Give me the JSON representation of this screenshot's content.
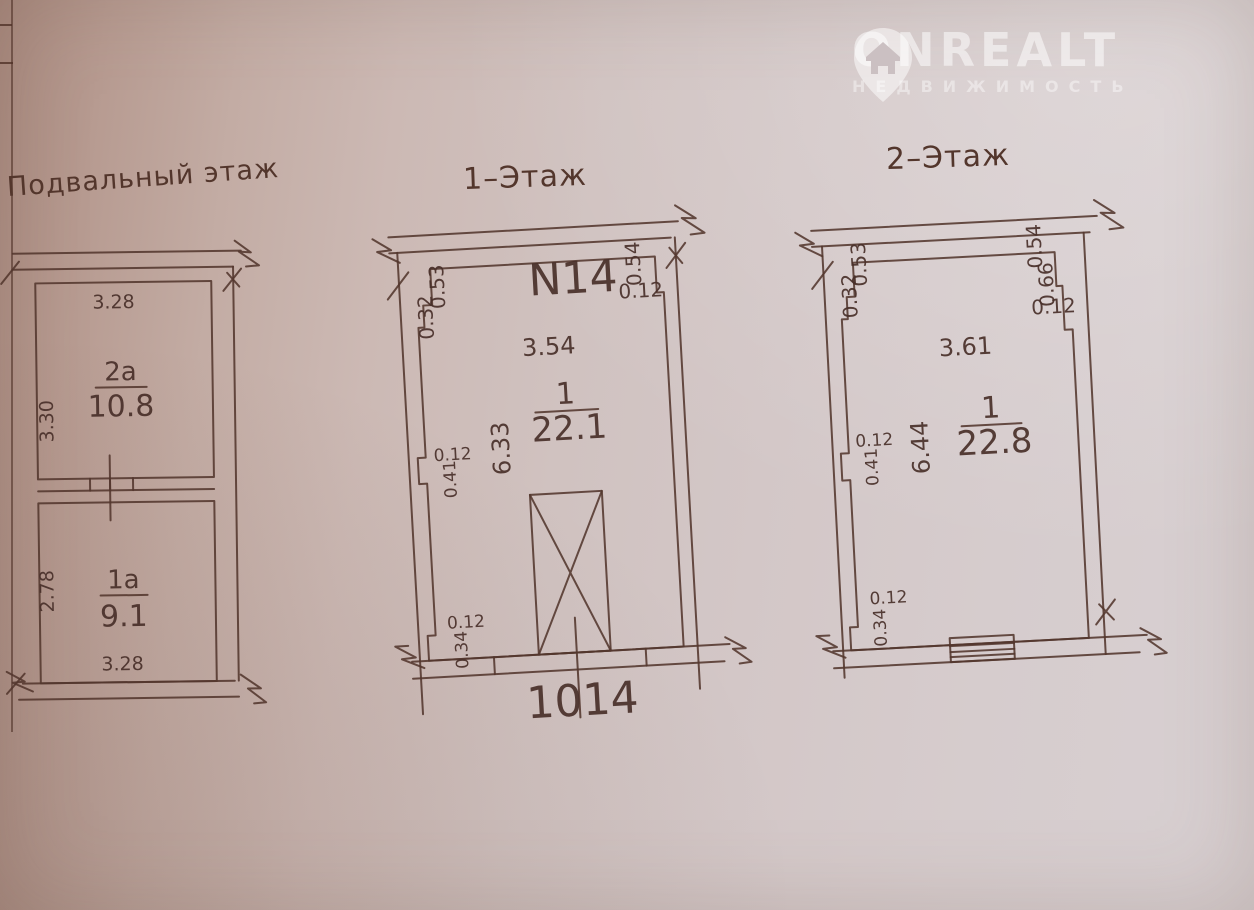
{
  "logo": {
    "brand": "ONREALT",
    "subtitle": "НЕДВИЖИМОСТЬ"
  },
  "basement": {
    "title": "Подвальный этаж",
    "room_top": {
      "label": "2а",
      "area": "10.8"
    },
    "room_bottom": {
      "label": "1а",
      "area": "9.1"
    },
    "dim_top": "3.28",
    "dim_left_top": "3.30",
    "dim_left_bottom": "2.78",
    "dim_bottom": "3.28"
  },
  "floor1": {
    "title": "1–Этаж",
    "unit": "N14",
    "room": {
      "label": "1",
      "area": "22.1"
    },
    "dim_width": "3.54",
    "dim_height": "6.33",
    "dim_tl_v": "0.53",
    "dim_tl_v2": "0.32",
    "dim_tr_v": "0.54",
    "dim_tr_h": "0.12",
    "dim_ml_h": "0.12",
    "dim_ml_v": "0.41",
    "dim_bl_h": "0.12",
    "dim_bl_v": "0.34",
    "bottom_number": "1014"
  },
  "floor2": {
    "title": "2–Этаж",
    "room": {
      "label": "1",
      "area": "22.8"
    },
    "dim_width": "3.61",
    "dim_height": "6.44",
    "dim_tl_v": "0.53",
    "dim_tl_v2": "0.32",
    "dim_tr_v": "0.54",
    "dim_tr_v2": "0.66",
    "dim_tr_h": "0.12",
    "dim_ml_h": "0.12",
    "dim_ml_v": "0.41",
    "dim_bl_h": "0.12",
    "dim_bl_v": "0.34"
  }
}
